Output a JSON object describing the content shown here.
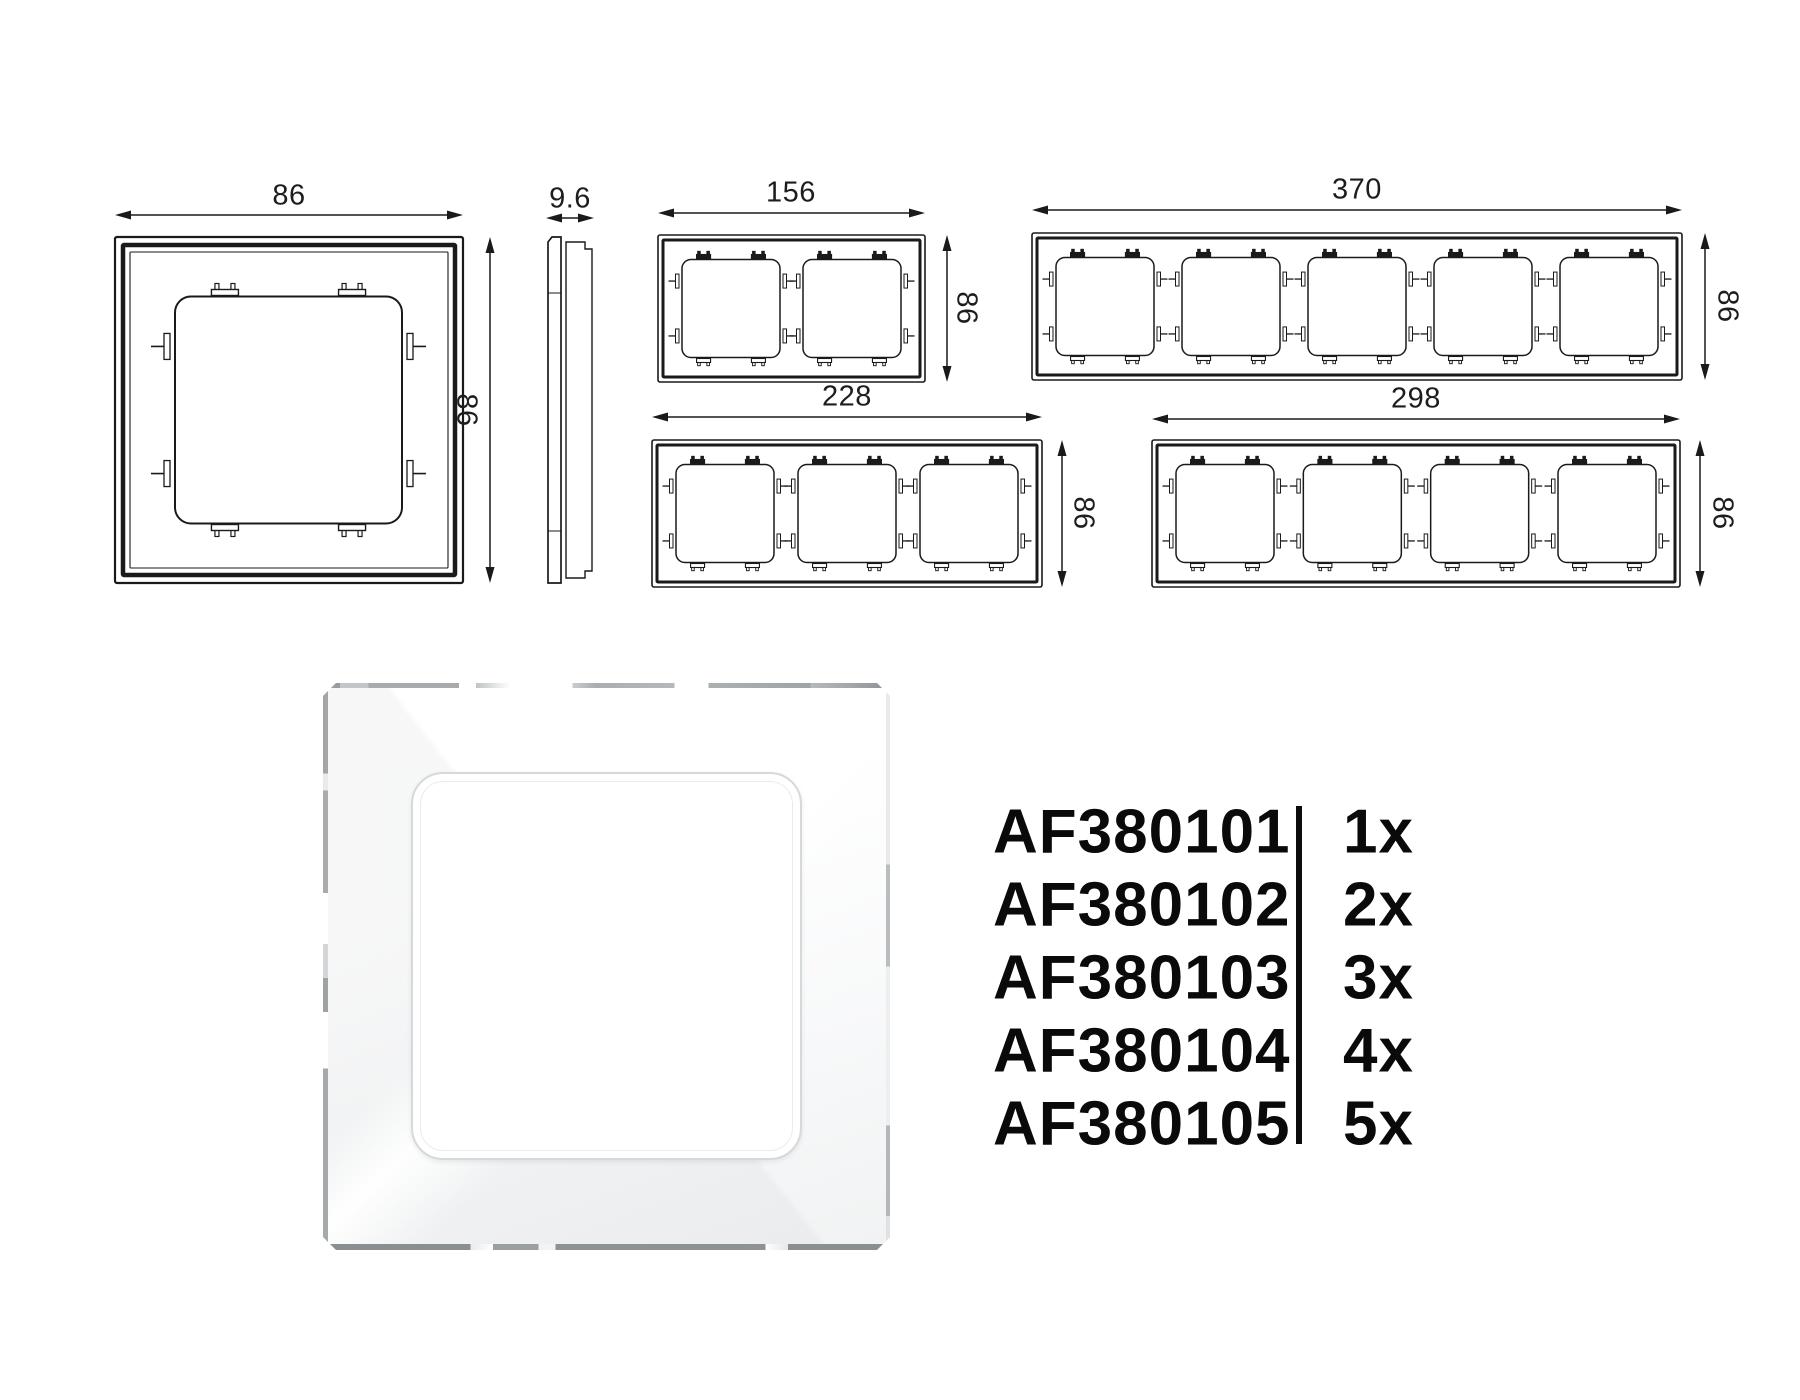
{
  "colors": {
    "line": "#1a1a1a",
    "background": "#ffffff",
    "text": "#0a0a0a"
  },
  "drawings": [
    {
      "name": "front-view-1-gang",
      "gangs": 1,
      "width_label": "86",
      "height_label": "86"
    },
    {
      "name": "side-view",
      "gangs": 0,
      "width_label": "9.6",
      "height_label": ""
    },
    {
      "name": "front-view-2-gang",
      "gangs": 2,
      "width_label": "156",
      "height_label": "86"
    },
    {
      "name": "front-view-5-gang",
      "gangs": 5,
      "width_label": "370",
      "height_label": "86"
    },
    {
      "name": "front-view-3-gang",
      "gangs": 3,
      "width_label": "228",
      "height_label": "86"
    },
    {
      "name": "front-view-4-gang",
      "gangs": 4,
      "width_label": "298",
      "height_label": "86"
    }
  ],
  "products": [
    {
      "sku": "AF380101",
      "qty": "1x"
    },
    {
      "sku": "AF380102",
      "qty": "2x"
    },
    {
      "sku": "AF380103",
      "qty": "3x"
    },
    {
      "sku": "AF380104",
      "qty": "4x"
    },
    {
      "sku": "AF380105",
      "qty": "5x"
    }
  ]
}
